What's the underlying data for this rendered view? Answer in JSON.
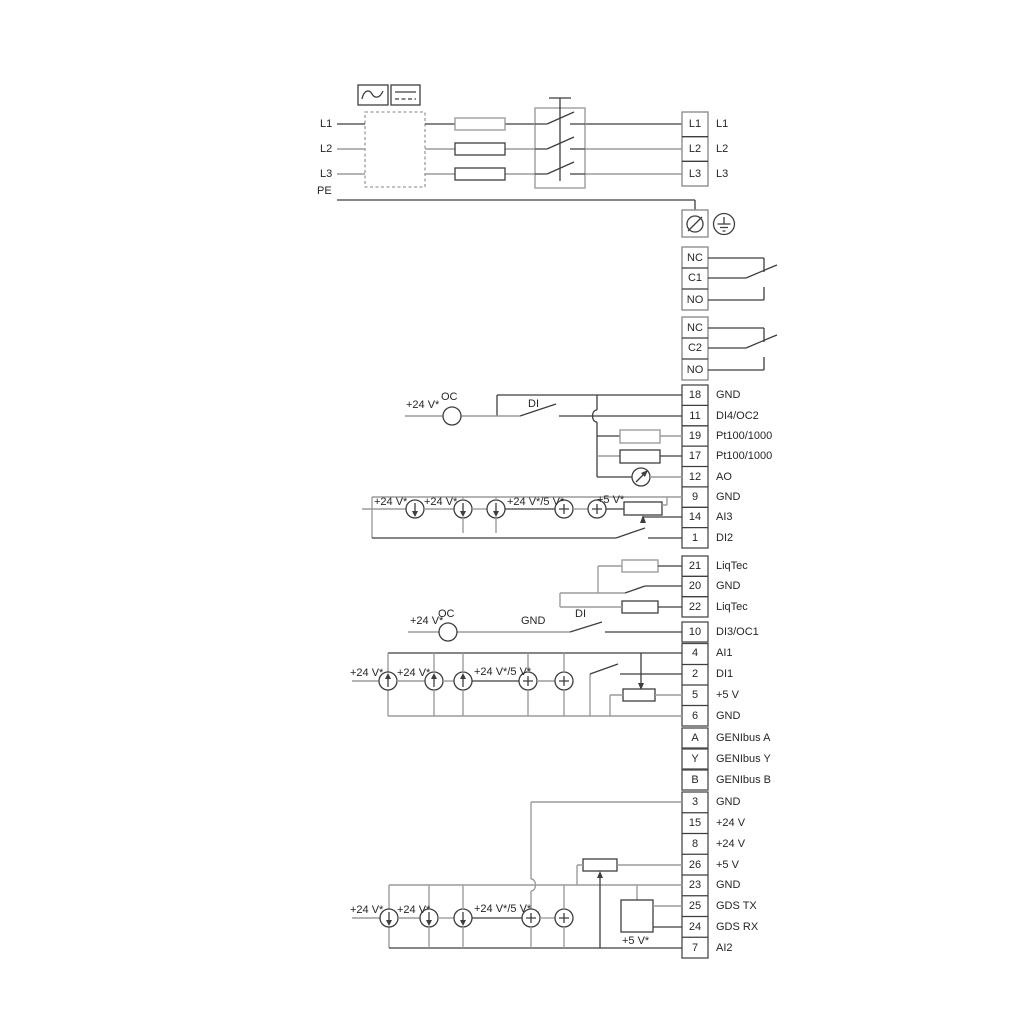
{
  "left_rail_labels": {
    "l1": "L1",
    "l2": "L2",
    "l3": "L3",
    "pe": "PE"
  },
  "power_block": {
    "terminals": [
      "L1",
      "L2",
      "L3"
    ]
  },
  "relay_block_1": {
    "terminals": [
      "NC",
      "C1",
      "NO"
    ]
  },
  "relay_block_2": {
    "terminals": [
      "NC",
      "C2",
      "NO"
    ]
  },
  "io_block_1": {
    "rows": [
      {
        "num": "18",
        "label": "GND"
      },
      {
        "num": "11",
        "label": "DI4/OC2"
      },
      {
        "num": "19",
        "label": "Pt100/1000"
      },
      {
        "num": "17",
        "label": "Pt100/1000"
      },
      {
        "num": "12",
        "label": "AO"
      },
      {
        "num": "9",
        "label": "GND"
      },
      {
        "num": "14",
        "label": "AI3"
      },
      {
        "num": "1",
        "label": "DI2"
      }
    ]
  },
  "liqtec_block": {
    "rows": [
      {
        "num": "21",
        "label": "LiqTec"
      },
      {
        "num": "20",
        "label": "GND"
      },
      {
        "num": "22",
        "label": "LiqTec"
      }
    ]
  },
  "di3_row": {
    "num": "10",
    "label": "DI3/OC1"
  },
  "io_block_2": {
    "rows": [
      {
        "num": "4",
        "label": "AI1"
      },
      {
        "num": "2",
        "label": "DI1"
      },
      {
        "num": "5",
        "label": "+5 V"
      },
      {
        "num": "6",
        "label": "GND"
      }
    ]
  },
  "genibus_block": {
    "rows": [
      {
        "num": "A",
        "label": "GENIbus A"
      },
      {
        "num": "Y",
        "label": "GENIbus Y"
      },
      {
        "num": "B",
        "label": "GENIbus B"
      }
    ]
  },
  "io_block_3": {
    "rows": [
      {
        "num": "3",
        "label": "GND"
      },
      {
        "num": "15",
        "label": "+24 V"
      },
      {
        "num": "8",
        "label": "+24 V"
      },
      {
        "num": "26",
        "label": "+5 V"
      },
      {
        "num": "23",
        "label": "GND"
      },
      {
        "num": "25",
        "label": "GDS TX"
      },
      {
        "num": "24",
        "label": "GDS RX"
      },
      {
        "num": "7",
        "label": "AI2"
      }
    ]
  },
  "wire_labels": {
    "v24": "+24 V*",
    "v24v5": "+24 V*/5 V*",
    "v5": "+5 V*",
    "oc": "OC",
    "di": "DI",
    "gnd": "GND"
  },
  "colors": {
    "wire_dark": "#3e3e3e",
    "wire_gray": "#9c9c9c",
    "text": "#262626",
    "background": "#ffffff"
  }
}
